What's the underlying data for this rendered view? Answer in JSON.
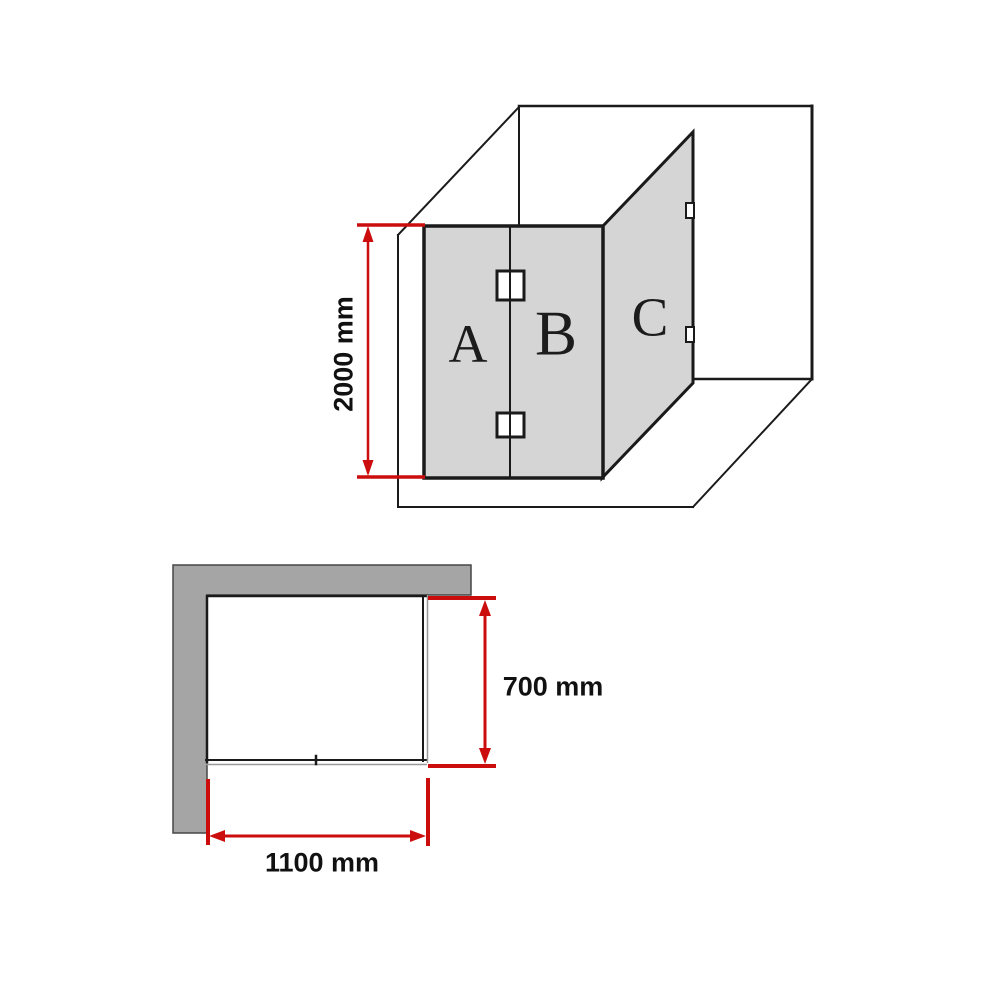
{
  "colors": {
    "dimension_red": "#cc0d0d",
    "glass_gray": "#d5d5d5",
    "wall_gray": "#a5a5a5",
    "glass_edge_gray": "#999999",
    "line_black": "#1a1a1a"
  },
  "isometric_view": {
    "panels": [
      {
        "label": "A"
      },
      {
        "label": "B"
      },
      {
        "label": "C"
      }
    ],
    "height_dimension": {
      "label": "2000 mm"
    }
  },
  "plan_view": {
    "depth_dimension": {
      "label": "700 mm"
    },
    "width_dimension": {
      "label": "1100 mm"
    }
  }
}
